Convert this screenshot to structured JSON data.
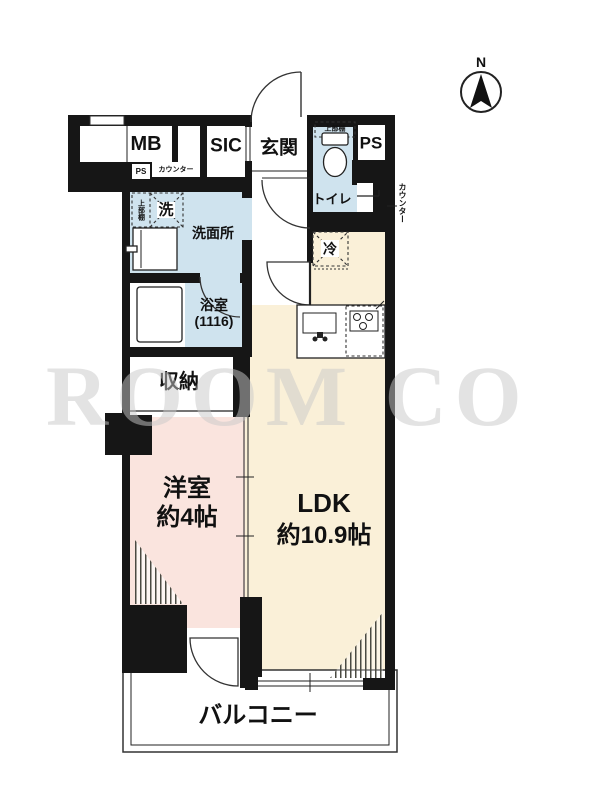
{
  "plan": {
    "labels": {
      "mb": "MB",
      "sic": "SIC",
      "entrance": "玄関",
      "ps_main": "PS",
      "ps_small": "PS",
      "counter_top": "カウンター",
      "counter_right": "カウンター",
      "washer": "洗",
      "washer_shelf": "上部棚",
      "toilet_shelf": "上部棚",
      "washroom": "洗面所",
      "toilet": "トイレ",
      "bathroom": "浴室",
      "bathroom_size": "(1116)",
      "storage": "収納",
      "refrigerator": "冷",
      "western_room": "洋室",
      "western_room_size": "約4帖",
      "ldk": "LDK",
      "ldk_size": "約10.9帖",
      "balcony": "バルコニー"
    },
    "compass": {
      "north": "N"
    },
    "watermark": "ROOM CO",
    "colors": {
      "wall": "#161616",
      "wet": "#cfe3ee",
      "ldk": "#faf0d8",
      "bed": "#fae4de",
      "wm": "#c9c9c9"
    }
  }
}
